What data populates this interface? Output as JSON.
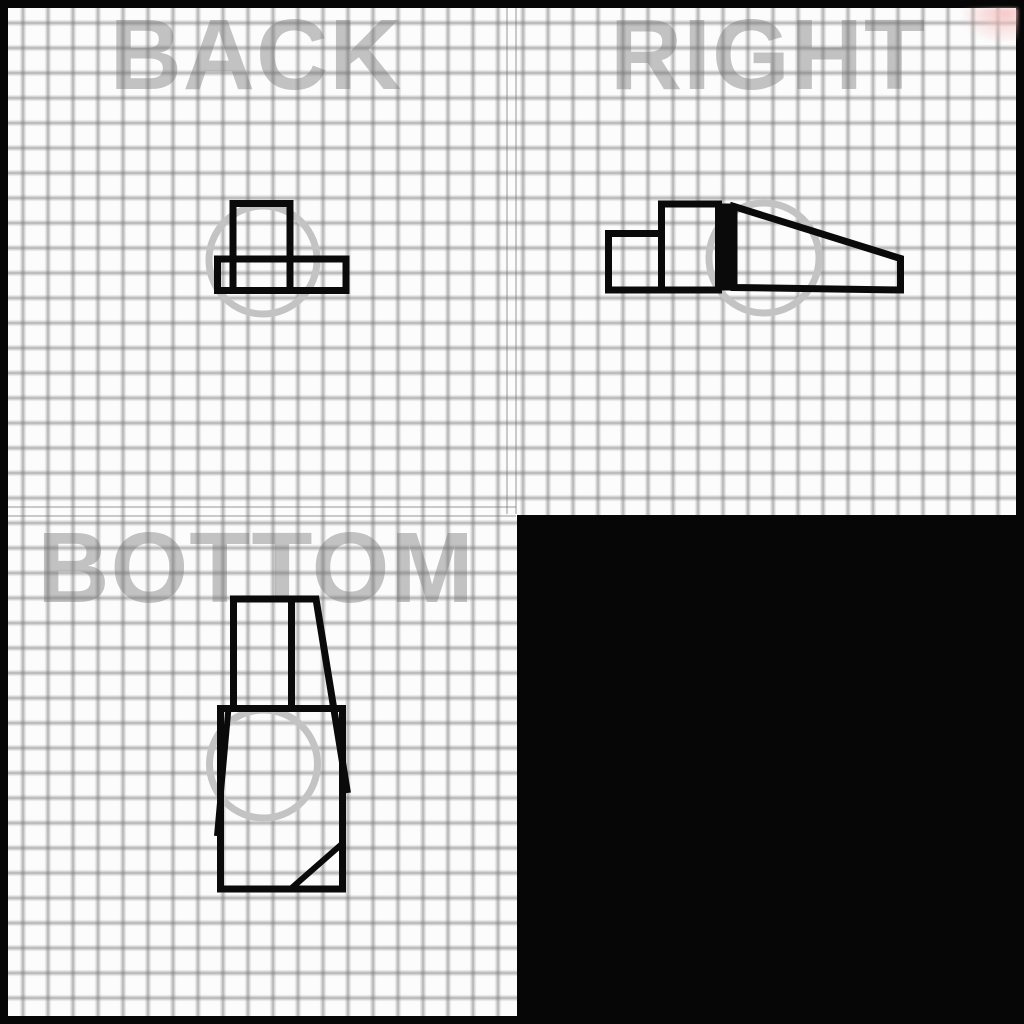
{
  "canvas": {
    "width": 1024,
    "height": 1024,
    "frame_color": "#060606",
    "paper_color": "#fcfcfc",
    "grid_color": "#737373",
    "grid_spacing_px": 25
  },
  "views": {
    "back": {
      "label": "BACK"
    },
    "right": {
      "label": "RIGHT"
    },
    "bottom": {
      "label": "BOTTOM"
    },
    "blank": {
      "label": "",
      "color": "#060606"
    }
  },
  "watermark": {
    "color": "#c2c2c2"
  },
  "artifact": {
    "color": "#f5c0c0"
  },
  "drawing": {
    "ink": "#0a0a0a",
    "guide_color": "#c3c3c3",
    "shapes": [
      {
        "name": "back-guide-circle",
        "type": "circle",
        "cx": 263,
        "cy": 260,
        "r": 54,
        "w": 7,
        "color": "#c3c3c3"
      },
      {
        "name": "right-guide-circle",
        "type": "circle",
        "cx": 764,
        "cy": 258,
        "r": 55,
        "w": 7,
        "color": "#c3c3c3"
      },
      {
        "name": "bottom-guide-circle",
        "type": "circle",
        "cx": 263.5,
        "cy": 764,
        "r": 54,
        "w": 7,
        "color": "#c3c3c3"
      },
      {
        "name": "back-view-upper-block",
        "type": "rect",
        "x": 233,
        "y": 203.5,
        "wd": 57,
        "ht": 87,
        "w": 7
      },
      {
        "name": "back-view-base-bar",
        "type": "rect",
        "x": 217.5,
        "y": 259,
        "wd": 128.5,
        "ht": 31.5,
        "w": 7
      },
      {
        "name": "right-view-low-step",
        "type": "rect",
        "x": 608.5,
        "y": 233.5,
        "wd": 53,
        "ht": 56.5,
        "w": 7
      },
      {
        "name": "right-view-high-step",
        "type": "rect",
        "x": 661.5,
        "y": 204,
        "wd": 57,
        "ht": 86,
        "w": 7
      },
      {
        "name": "right-view-thick-edge",
        "type": "fillrect",
        "x": 718.5,
        "y": 203.5,
        "wd": 15.5,
        "ht": 87
      },
      {
        "name": "right-view-wedge",
        "type": "polygon",
        "pts": [
          [
            734,
            206.5
          ],
          [
            900.5,
            258.5
          ],
          [
            900.5,
            290
          ],
          [
            734,
            287.5
          ]
        ],
        "w": 7
      },
      {
        "name": "bottom-view-neck-outline",
        "type": "polyline",
        "pts": [
          [
            233.5,
            712
          ],
          [
            233.5,
            599
          ],
          [
            316,
            599
          ],
          [
            347.5,
            793
          ]
        ],
        "w": 7
      },
      {
        "name": "bottom-view-neck-divider",
        "type": "line",
        "pts": [
          [
            291.5,
            599
          ],
          [
            291.5,
            712
          ]
        ],
        "w": 7
      },
      {
        "name": "bottom-view-left-taper",
        "type": "line",
        "pts": [
          [
            228.5,
            708
          ],
          [
            217,
            836
          ]
        ],
        "w": 6
      },
      {
        "name": "bottom-view-base",
        "type": "rect",
        "x": 220.5,
        "y": 708.5,
        "wd": 122,
        "ht": 180.5,
        "w": 7
      },
      {
        "name": "bottom-view-chamfer",
        "type": "line",
        "pts": [
          [
            290.5,
            889
          ],
          [
            343,
            843
          ]
        ],
        "w": 6
      }
    ]
  }
}
